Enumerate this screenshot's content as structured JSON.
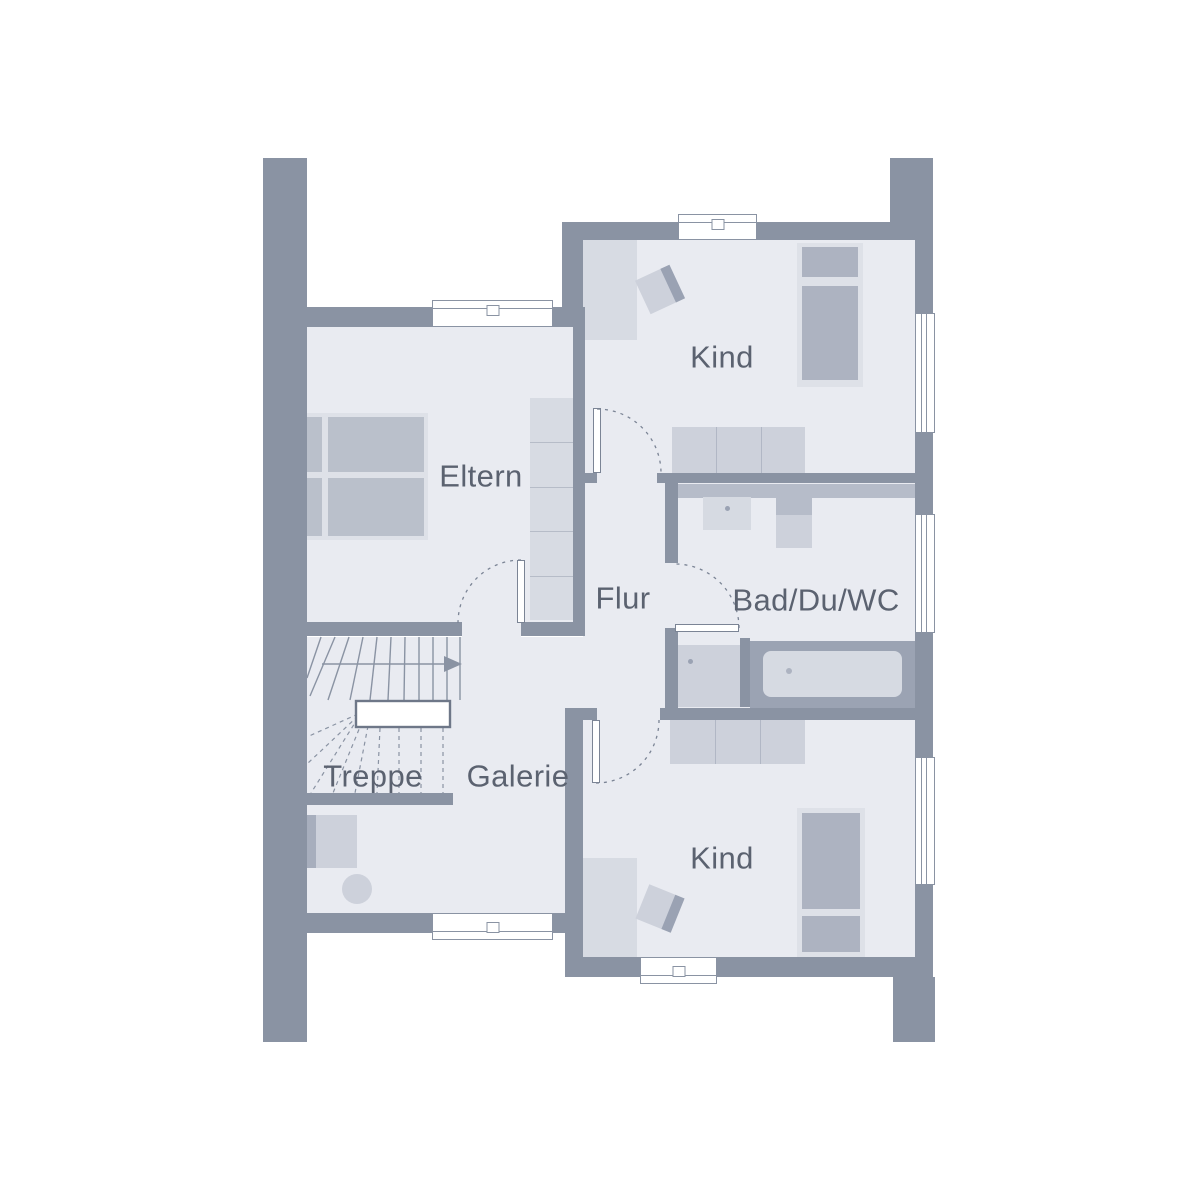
{
  "rooms": {
    "eltern": {
      "label": "Eltern"
    },
    "kind_top": {
      "label": "Kind"
    },
    "flur": {
      "label": "Flur"
    },
    "bad": {
      "label": "Bad/Du/WC"
    },
    "treppe": {
      "label": "Treppe"
    },
    "galerie": {
      "label": "Galerie"
    },
    "kind_bottom": {
      "label": "Kind"
    }
  },
  "colors": {
    "background": "#FFFFFF",
    "wall": "#8A93A3",
    "floor": "#E9EBF1",
    "furniture-light": "#D7DBE3",
    "furniture-medium": "#CDD1DB",
    "furniture-dark": "#9AA2B3",
    "bed-frame": "#DEE1E8",
    "bed-panel": "#BAC0CB",
    "mattress": "#ADB3C1",
    "tub-surround": "#9BA3B3",
    "tub-inner": "#D6DAE2",
    "shelf": "#B6BCC9",
    "door-line": "#7B8495",
    "stair-line": "#8A93A3",
    "landing-border": "#6E7788",
    "text": "#5B6270"
  }
}
